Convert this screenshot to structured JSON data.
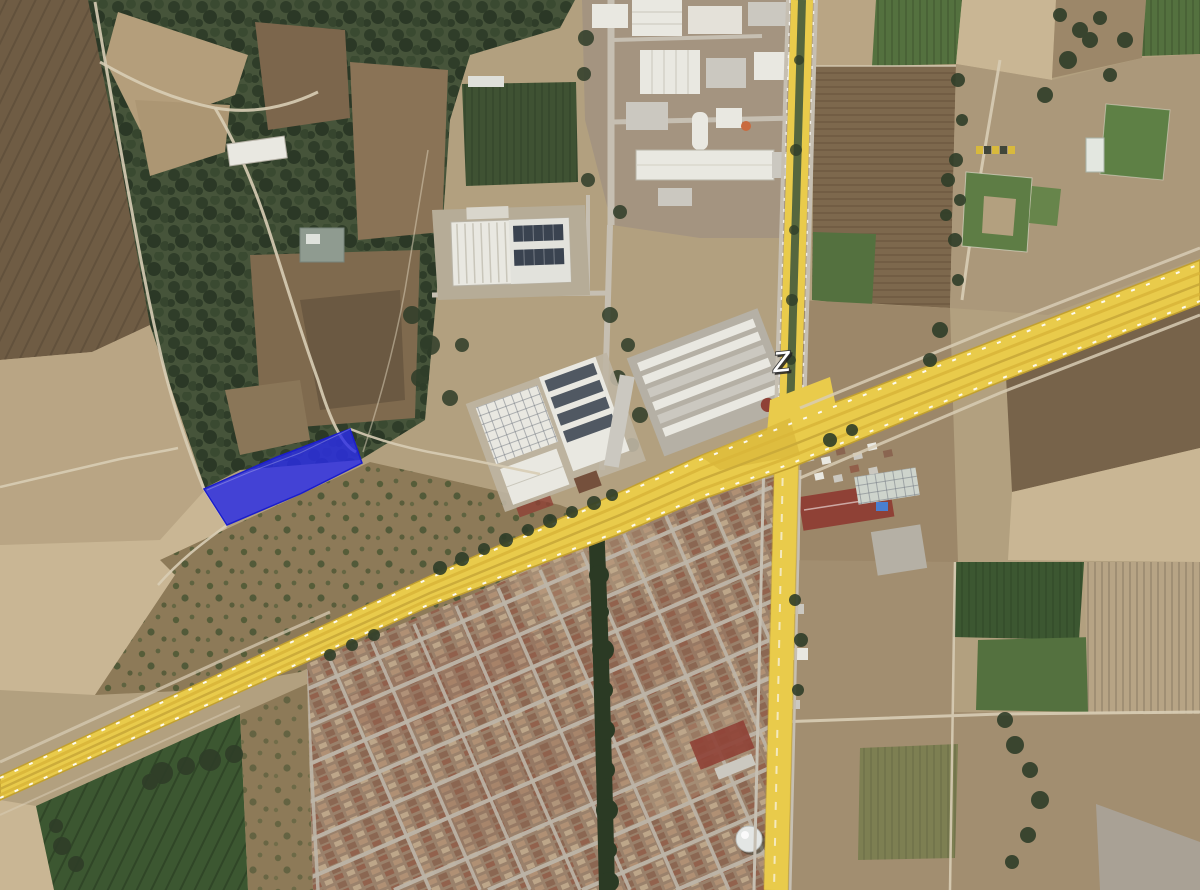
{
  "view": {
    "type": "satellite-aerial-view",
    "description": "Aerial imagery of a semi-rural area: forest and farm fields, an industrial corridor, a dense housing tract, a highlighted highway route, a highlighted cross road and a selected land parcel"
  },
  "labels": {
    "road_letter": "Z"
  },
  "overlays": {
    "parcel": {
      "name": "highlighted-parcel",
      "shape": "quadrilateral",
      "opacity": 0.82
    },
    "route_main": {
      "name": "highway-route-highlight"
    },
    "route_cross": {
      "name": "cross-road-highlight"
    }
  },
  "features": [
    "forest-scrubland",
    "plowed-fields",
    "industrial-park",
    "warehouse-complex",
    "residential-grid",
    "tree-lined-canal",
    "sports-fields",
    "red-roof-warehouse",
    "water-tank",
    "farm-plots",
    "highway",
    "cross-road",
    "selected-parcel"
  ],
  "colors": {
    "base_tan": "#b2a07f",
    "field_dark_brown": "#6f5c44",
    "field_brown": "#7d684d",
    "field_brown_dark": "#77634a",
    "field_tan": "#b9a584",
    "field_tan_light": "#c9b694",
    "field_olive": "#8d7a58",
    "scrub": "#9c8769",
    "clearing_brown": "#7f6a4e",
    "clearing_shadow": "#6b5942",
    "forest": "#46543a",
    "forest_dark": "#2f3d29",
    "orchard_green": "#3f5233",
    "crop_green_dark": "#3c5731",
    "crop_green": "#54713f",
    "crop_green_bright": "#5e8045",
    "pitch_green": "#5e7d45",
    "pitch_green2": "#67854b",
    "pitch_worn": "#b3a07f",
    "canal_green": "#2b3a24",
    "residential_base": "#9a816b",
    "res_roof_a": "#b29175",
    "res_roof_b": "#8a6550",
    "res_roof_c": "#c0a98c",
    "res_roof_d": "#915f4a",
    "street_gray": "#bdb5a8",
    "road_gray": "#c6bfb2",
    "path_light": "#d8cdb5",
    "building_white": "#e9e8e1",
    "building_gray": "#cbc8c0",
    "concrete": "#b6ac97",
    "roof_red": "#8f4136",
    "roof_red_dark": "#75503c",
    "solar_dark": "#3a4350",
    "slab_gray": "#b5b0a5",
    "greenhouse_white": "#ced4cc",
    "median_green": "#55663e",
    "highway_yellow": "#e9cb4b",
    "highway_yellow_dark": "#d9b63a",
    "highway_mid": "#c9a938",
    "highway_edge": "#c2a02f",
    "marking_white": "#ffffff",
    "parcel_blue": "#2b2de8",
    "parcel_blue_dark": "#1b1ecb",
    "pool_blue": "#4a7fd0",
    "tank_white": "#e3e6e4",
    "orange_tank": "#c96b3f"
  }
}
